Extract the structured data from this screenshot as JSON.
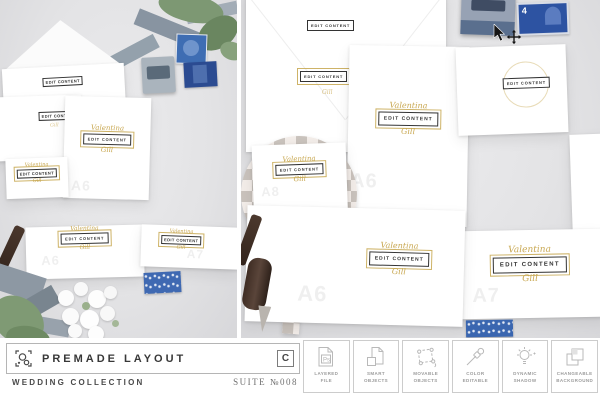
{
  "mockup": {
    "edit_label": "EDIT CONTENT",
    "script_first": "Valentina",
    "script_last": "Gill",
    "watermark_a6": "A6",
    "watermark_a7": "A7",
    "watermark_a8": "A8",
    "stamp_denomination": "4"
  },
  "footer": {
    "brand": {
      "logo_icon": "objects-frame-icon",
      "title": "PREMADE LAYOUT",
      "badge_letter": "C",
      "collection": "WEDDING COLLECTION",
      "suite": "SUITE №008"
    },
    "features": [
      {
        "icon": "layered-file-icon",
        "icon_text": "Ps",
        "line1": "LAYERED",
        "line2": "FILE"
      },
      {
        "icon": "smart-objects-icon",
        "line1": "SMART",
        "line2": "OBJECTS"
      },
      {
        "icon": "movable-objects-icon",
        "line1": "MOVABLE",
        "line2": "OBJECTS"
      },
      {
        "icon": "color-editable-icon",
        "line1": "COLOR",
        "line2": "EDITABLE"
      },
      {
        "icon": "dynamic-shadow-icon",
        "line1": "DYNAMIC",
        "line2": "SHADOW"
      },
      {
        "icon": "changeable-background-icon",
        "line1": "CHANGEABLE",
        "line2": "BACKGROUND"
      }
    ]
  },
  "colors": {
    "accent_gold": "#c6a64c",
    "stamp_blue": "#3a66b0",
    "background_gray": "#e3e3e5",
    "checker_gray": "#c9c2bc",
    "label_border": "#333333",
    "footer_border": "#c9c9c9"
  }
}
